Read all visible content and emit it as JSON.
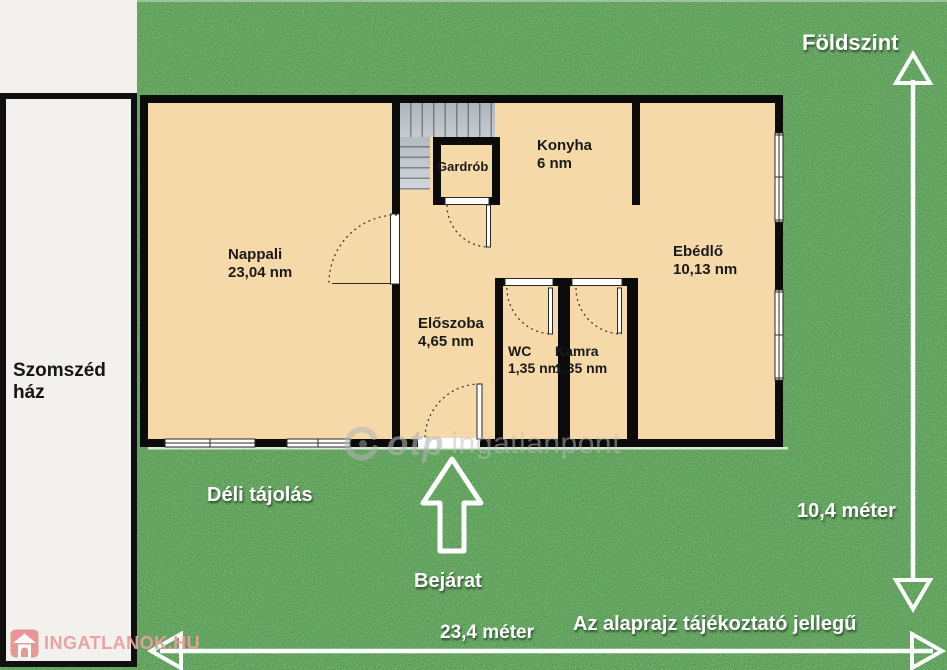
{
  "floor_title": "Földszint",
  "neighbor": {
    "label": "Szomszéd\nház"
  },
  "rooms": [
    {
      "name": "Nappali",
      "area": "23,04 nm"
    },
    {
      "name": "Gardrób",
      "area": ""
    },
    {
      "name": "Konyha",
      "area": "6 nm"
    },
    {
      "name": "Ebédlő",
      "area": "10,13 nm"
    },
    {
      "name": "Előszoba",
      "area": "4,65 nm"
    },
    {
      "name": "WC",
      "area": "1,35 nm"
    },
    {
      "name": "Kamra",
      "area": "1,35 nm"
    }
  ],
  "annotations": {
    "orientation": "Déli tájolás",
    "entrance": "Bejárat",
    "disclaimer": "Az alaprajz tájékoztató jellegű"
  },
  "measurements": {
    "plan_width": "23,4 méter",
    "plan_height": "10,4 méter"
  },
  "watermark": {
    "brand": "otp",
    "suffix": "ingatlanpont"
  },
  "logo": {
    "text": "INGATLANOK.HU"
  },
  "colors": {
    "grass": "#2a5a2c",
    "floor": "#f6d9a9",
    "wall": "#0b0b0b",
    "neighbor_fill": "#f2f1ed",
    "stairs": "#bcc2c7",
    "label_white": "#ffffff",
    "logo_pink": "#eb9d9d",
    "watermark_gray": "#b9c0ba"
  }
}
